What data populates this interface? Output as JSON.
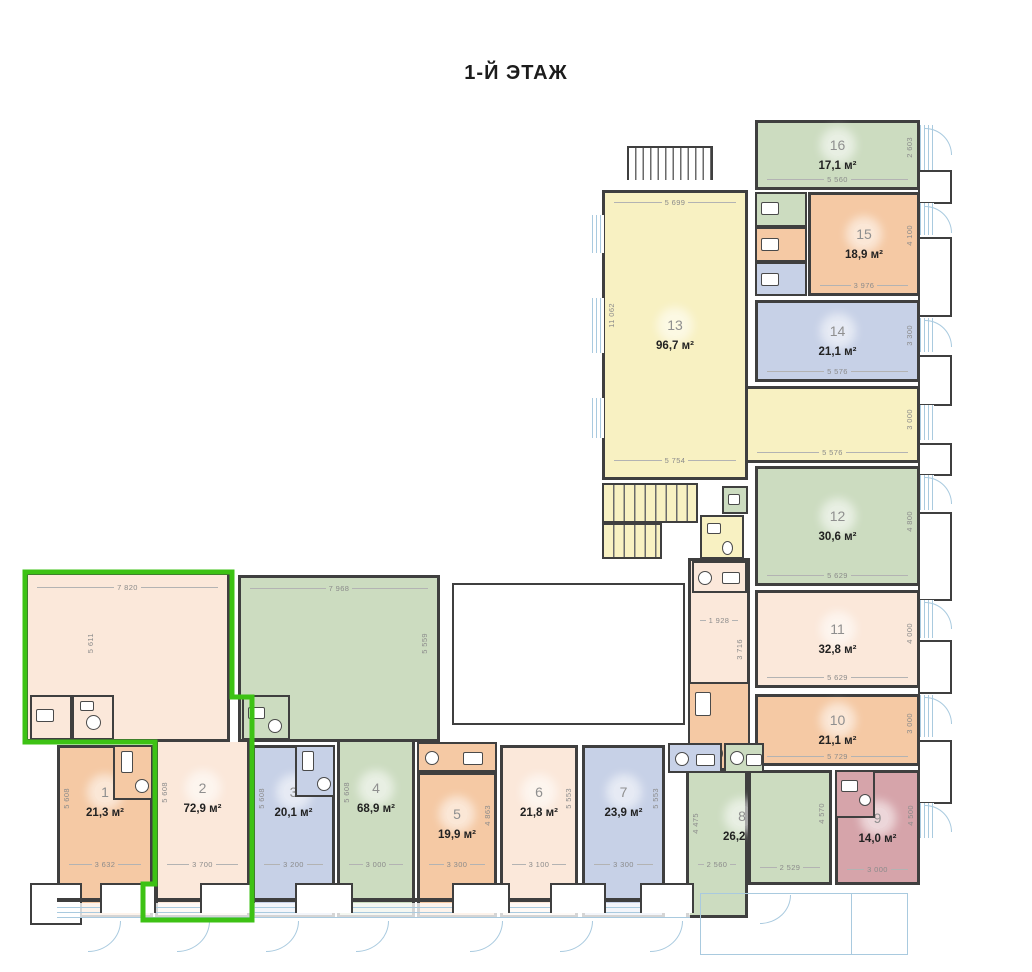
{
  "title": "1-Й ЭТАЖ",
  "colors": {
    "orange": "#f5c9a4",
    "cream": "#fbe8da",
    "lavender": "#c7d1e7",
    "green": "#ccdcc0",
    "yellow": "#f8f1c2",
    "pink": "#d6a4aa",
    "highlight": "#3dc214",
    "wall": "#3f3f3f",
    "dim_text": "#8b8b8b",
    "window": "#a9cadf"
  },
  "rooms": [
    {
      "number": "1",
      "area": "21,3 м²",
      "d_bottom": "3 632",
      "d_left": "5 608"
    },
    {
      "number": "2",
      "area": "72,9 м²",
      "d_bottom": "3 700",
      "d_left": "5 608",
      "d_top": "7 820",
      "d_top_left": "5 611"
    },
    {
      "number": "3",
      "area": "20,1 м²",
      "d_bottom": "3 200",
      "d_left": "5 608"
    },
    {
      "number": "4",
      "area": "68,9 м²",
      "d_bottom": "3 000",
      "d_left": "5 608",
      "d_top": "7 968",
      "d_top_right": "5 559"
    },
    {
      "number": "5",
      "area": "19,9 м²",
      "d_bottom": "3 300",
      "d_right": "4 863"
    },
    {
      "number": "6",
      "area": "21,8 м²",
      "d_bottom": "3 100",
      "d_right": "5 553"
    },
    {
      "number": "7",
      "area": "23,9 м²",
      "d_bottom": "3 300",
      "d_right": "5 553"
    },
    {
      "number": "8",
      "area": "26,2 м²",
      "d_bottom": "2 560",
      "d_left": "4 475",
      "d_bottom2": "2 529",
      "d_right2": "4 570"
    },
    {
      "number": "9",
      "area": "14,0 м²",
      "d_bottom": "3 000",
      "d_right": "4 500"
    },
    {
      "number": "10",
      "area": "21,1 м²",
      "d_bottom": "5 729",
      "d_right": "3 000"
    },
    {
      "number": "11",
      "area": "32,8 м²",
      "d_bottom": "5 629",
      "d_right": "4 000"
    },
    {
      "number": "12",
      "area": "30,6 м²",
      "d_bottom": "5 629",
      "d_right": "4 800"
    },
    {
      "number": "13",
      "area": "96,7 м²",
      "d_top": "5 699",
      "d_left": "11 062",
      "d_bottom": "5 754"
    },
    {
      "number": "14",
      "area": "21,1 м²",
      "d_bottom": "5 576",
      "d_right": "3 300"
    },
    {
      "number": "15",
      "area": "18,9 м²",
      "d_bottom": "3 976",
      "d_right": "4 100"
    },
    {
      "number": "16",
      "area": "17,1 м²",
      "d_bottom": "5 560",
      "d_right": "2 603"
    }
  ],
  "corridor": {
    "d_bottom": "5 576",
    "d_right": "3 000"
  },
  "hall": {
    "d_width": "1 928",
    "d_height": "3 716"
  }
}
